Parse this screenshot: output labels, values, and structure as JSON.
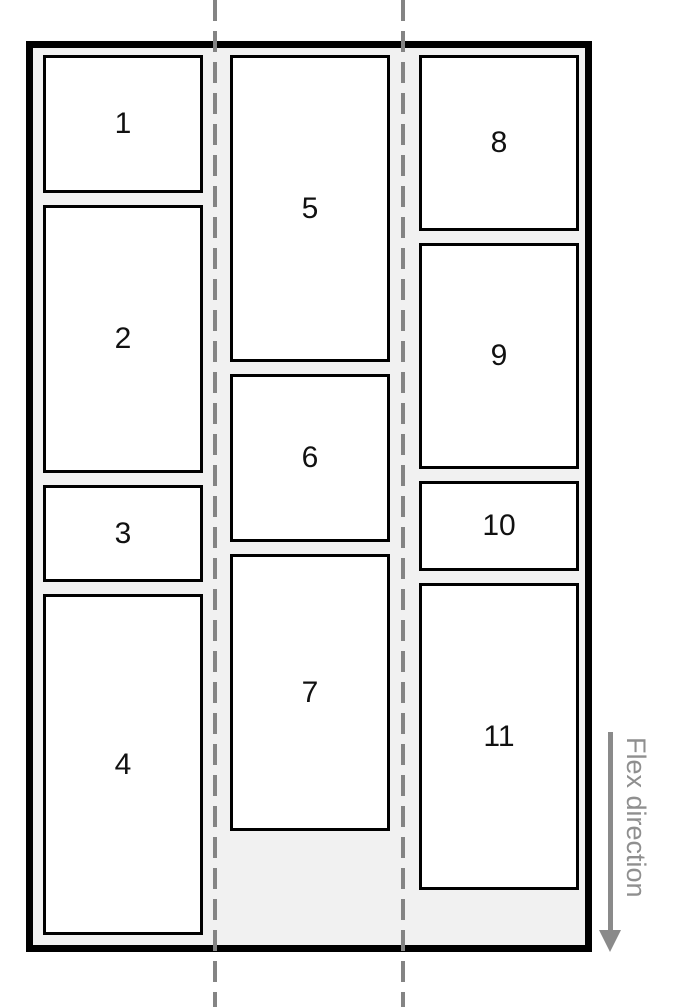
{
  "diagram": {
    "flex_direction_label": "Flex direction",
    "columns": [
      {
        "items": [
          {
            "label": "1"
          },
          {
            "label": "2"
          },
          {
            "label": "3"
          },
          {
            "label": "4"
          }
        ]
      },
      {
        "items": [
          {
            "label": "5"
          },
          {
            "label": "6"
          },
          {
            "label": "7"
          }
        ]
      },
      {
        "items": [
          {
            "label": "8"
          },
          {
            "label": "9"
          },
          {
            "label": "10"
          },
          {
            "label": "11"
          }
        ]
      }
    ],
    "colors": {
      "page_background": "#ffffff",
      "container_fill": "#f1f1f1",
      "container_border": "#000000",
      "item_fill": "#ffffff",
      "item_border": "#000000",
      "item_text": "#111111",
      "dashed_line": "#848484",
      "arrow": "#8a8a8a",
      "label_text": "#8f8f8f"
    }
  }
}
